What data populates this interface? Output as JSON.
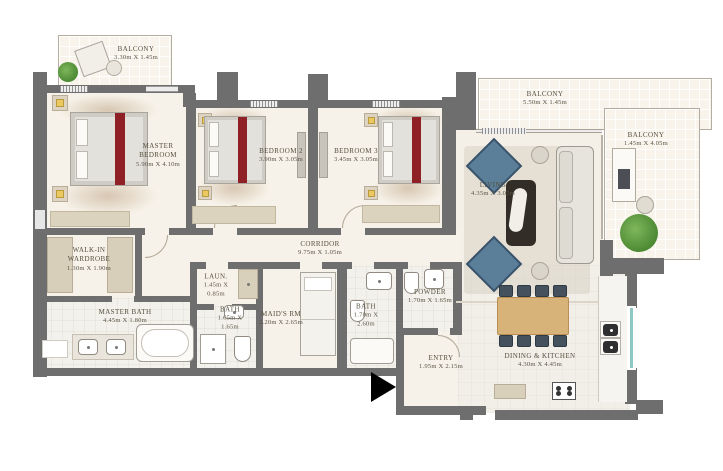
{
  "rooms": {
    "balcony_top_left": {
      "name": "BALCONY",
      "dims": "3.30m X 1.45m"
    },
    "master_bedroom": {
      "name": "MASTER BEDROOM",
      "dims": "5.90m X 4.10m"
    },
    "bedroom_2": {
      "name": "BEDROOM 2",
      "dims": "3.90m X 3.05m"
    },
    "bedroom_3": {
      "name": "BEDROOM 3",
      "dims": "3.45m X 3.05m"
    },
    "balcony_top_right": {
      "name": "BALCONY",
      "dims": "5.50m X 1.45m"
    },
    "balcony_right": {
      "name": "BALCONY",
      "dims": "1.45m X 4.05m"
    },
    "living": {
      "name": "LIVING",
      "dims": "4.35m X 3.05m"
    },
    "walk_in_wardrobe": {
      "name": "WALK-IN WARDROBE",
      "dims": "1.30m X 1.90m"
    },
    "corridor": {
      "name": "CORRIDOR",
      "dims": "9.75m X 1.05m"
    },
    "laundry": {
      "name": "LAUN.",
      "dims": "1.45m X 0.85m"
    },
    "master_bath": {
      "name": "MASTER BATH",
      "dims": "4.45m X 1.80m"
    },
    "bath_2": {
      "name": "BATH",
      "dims": "1.65m X 1.65m"
    },
    "maids_room": {
      "name": "MAID'S RM",
      "dims": "2.20m X 2.65m"
    },
    "bath_3": {
      "name": "BATH",
      "dims": "1.70m X 2.60m"
    },
    "powder": {
      "name": "POWDER",
      "dims": "1.70m X 1.65m"
    },
    "entry": {
      "name": "ENTRY",
      "dims": "1.95m X 2.15m"
    },
    "dining_kitchen": {
      "name": "DINING & KITCHEN",
      "dims": "4.30m X 4.45m"
    }
  },
  "colors": {
    "wall": "#6e6e6e",
    "floor": "#f7f2e9",
    "accent_red": "#8e2026",
    "chair_blue": "#5b7e99",
    "wood": "#d7b379",
    "plant_green": "#5f9c41",
    "window_teal": "#8fc7c4",
    "label_text": "#55503f"
  }
}
